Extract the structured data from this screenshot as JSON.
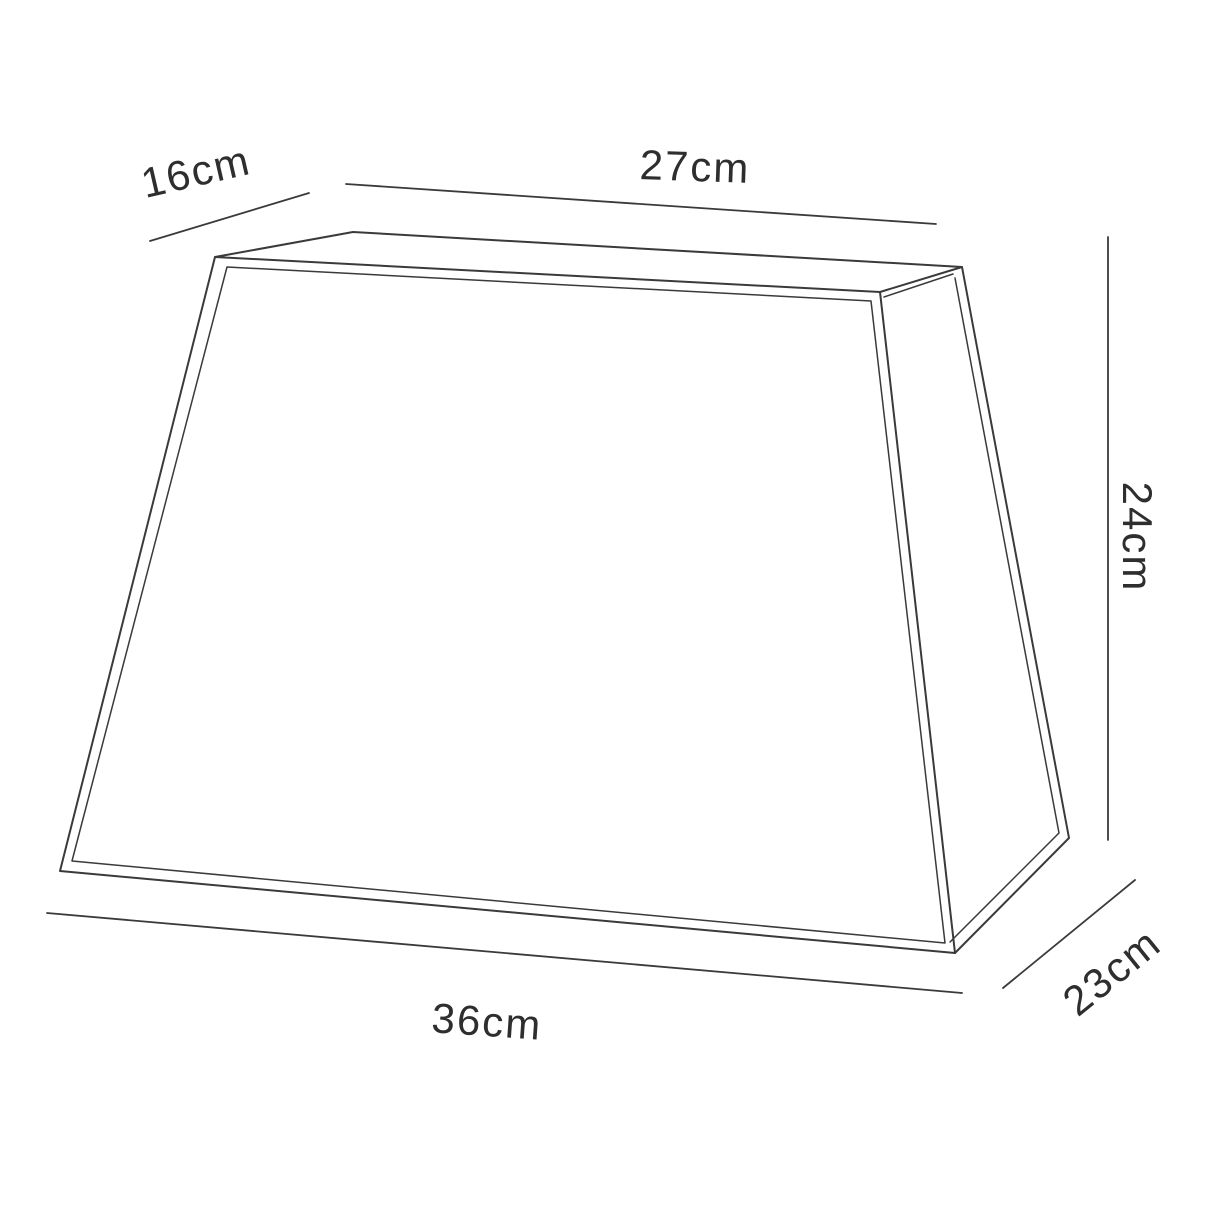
{
  "title": "Lampshade dimension line drawing",
  "colors": {
    "background": "#ffffff",
    "line": "#3a3a3a",
    "text": "#2e2e2e"
  },
  "diagram": {
    "width": 1214,
    "height": 1214,
    "shape_polylines": [
      {
        "name": "front-face-outer",
        "closed": true,
        "stroke_width": 2.0,
        "points": [
          [
            215,
            257
          ],
          [
            880,
            292
          ],
          [
            955,
            953
          ],
          [
            60,
            871
          ]
        ]
      },
      {
        "name": "front-face-inner",
        "closed": true,
        "stroke_width": 1.5,
        "points": [
          [
            227,
            267
          ],
          [
            871,
            301
          ],
          [
            945,
            943
          ],
          [
            72,
            861
          ]
        ]
      },
      {
        "name": "top-face-edges",
        "closed": false,
        "stroke_width": 2.0,
        "points": [
          [
            215,
            257
          ],
          [
            353,
            232
          ],
          [
            962,
            267
          ],
          [
            880,
            292
          ]
        ]
      },
      {
        "name": "top-face-inner-edge",
        "closed": false,
        "stroke_width": 1.5,
        "points": [
          [
            953,
            274
          ],
          [
            884,
            297
          ]
        ]
      },
      {
        "name": "side-face-edges",
        "closed": false,
        "stroke_width": 2.0,
        "points": [
          [
            962,
            267
          ],
          [
            1069,
            838
          ],
          [
            955,
            953
          ]
        ]
      },
      {
        "name": "side-face-inner",
        "closed": false,
        "stroke_width": 1.5,
        "points": [
          [
            955,
            278
          ],
          [
            1059,
            833
          ],
          [
            950,
            942
          ]
        ]
      }
    ],
    "dimension_lines": [
      {
        "name": "dim-line-16cm",
        "stroke_width": 1.8,
        "points": [
          [
            150,
            241
          ],
          [
            309,
            193
          ]
        ]
      },
      {
        "name": "dim-line-27cm",
        "stroke_width": 1.8,
        "points": [
          [
            346,
            184
          ],
          [
            936,
            224
          ]
        ]
      },
      {
        "name": "dim-line-24cm",
        "stroke_width": 1.8,
        "points": [
          [
            1108,
            237
          ],
          [
            1108,
            840
          ]
        ]
      },
      {
        "name": "dim-line-23cm",
        "stroke_width": 1.8,
        "points": [
          [
            1003,
            988
          ],
          [
            1135,
            880
          ]
        ]
      },
      {
        "name": "dim-line-36cm",
        "stroke_width": 1.8,
        "points": [
          [
            47,
            913
          ],
          [
            962,
            993
          ]
        ]
      }
    ],
    "labels": [
      {
        "text": "16cm",
        "x": 196,
        "y": 172,
        "rotate": -13
      },
      {
        "text": "27cm",
        "x": 695,
        "y": 167,
        "rotate": 2
      },
      {
        "text": "24cm",
        "x": 1137,
        "y": 537,
        "rotate": 90
      },
      {
        "text": "23cm",
        "x": 1112,
        "y": 972,
        "rotate": -39
      },
      {
        "text": "36cm",
        "x": 487,
        "y": 1022,
        "rotate": 4
      }
    ]
  }
}
